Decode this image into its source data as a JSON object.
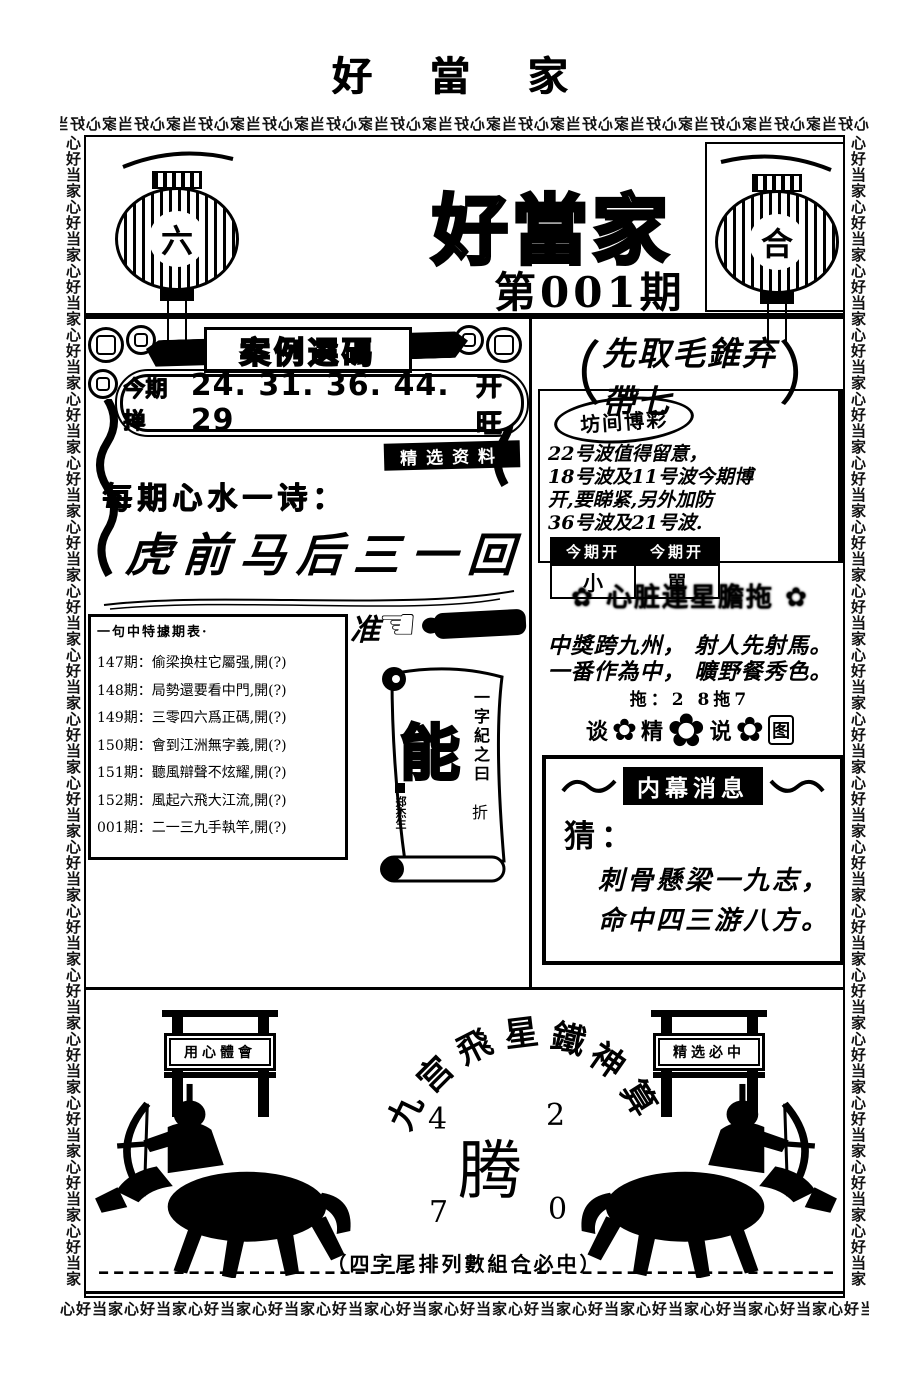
{
  "page_title": "好 當 家",
  "border": {
    "pattern": "心好当家"
  },
  "masthead": {
    "title": "好當家",
    "issue": "第001期",
    "left_lantern_char": "六",
    "right_lantern_char": "合"
  },
  "left": {
    "banner_title": "案例選碼",
    "pill": {
      "label": "今期掸",
      "numbers": "24. 31. 36. 44. 29",
      "result": "开旺"
    },
    "badge": "精选资料",
    "heart_label": "每期心水一诗：",
    "heart_poem": "虎前马后三一回",
    "list": {
      "header": "一句中特據期表·",
      "items": [
        "147期：偷梁换柱它屬强,開(?)",
        "148期：局勢還要看中門,開(?)",
        "149期：三零四六爲正碼,開(?)",
        "150期：會到江洲無字義,開(?)",
        "151期：聽風辯聲不炫耀,開(?)",
        "152期：風起六飛大江流,開(?)",
        "001期：二一三九手執竿,開(?)"
      ]
    },
    "pointer_char": "准",
    "scroll": {
      "side_text": "一字紀之曰",
      "fold": "折",
      "big_char": "能",
      "signature": "郑杰生"
    }
  },
  "right": {
    "bracket_open": "（",
    "bracket_close": "）",
    "headline": "先取毛錐弃帶七",
    "stamp": "坊间博彩",
    "advice_lines": [
      "22号波值得留意，",
      "18号波及11号波今期博",
      "开,要睇紧,另外加防",
      "36号波及21号波."
    ],
    "table": {
      "headers": [
        "今期开",
        "今期开"
      ],
      "values": [
        "小",
        "單"
      ]
    },
    "deco_header": "心脏連星膽拖",
    "verse_lines": [
      "中獎跨九州， 射人先射馬。",
      "一番作為中， 曠野餐秀色。"
    ],
    "tuo_line": "拖：2 8拖7",
    "flower_row": {
      "chars": [
        "谈",
        "精",
        "说",
        "图"
      ]
    },
    "inside": {
      "title": "内幕消息",
      "guess_label": "猜：",
      "lines": [
        "刺骨懸梁一九志，",
        "命中四三游八方。"
      ]
    }
  },
  "bottom": {
    "arc_chars": [
      "九",
      "宫",
      "飛",
      "星",
      "鐵",
      "神",
      "算"
    ],
    "numbers": {
      "top_left": "4",
      "top_right": "2",
      "center": "腾",
      "bottom_left": "7",
      "bottom_right": "0"
    },
    "left_sign": "用心體會",
    "right_sign": "精选必中",
    "caption": "（四字尾排列數組合必中）"
  },
  "icons": {
    "flower": "✿",
    "pointing_hand": "☜"
  },
  "colors": {
    "ink": "#000000",
    "paper": "#ffffff"
  }
}
